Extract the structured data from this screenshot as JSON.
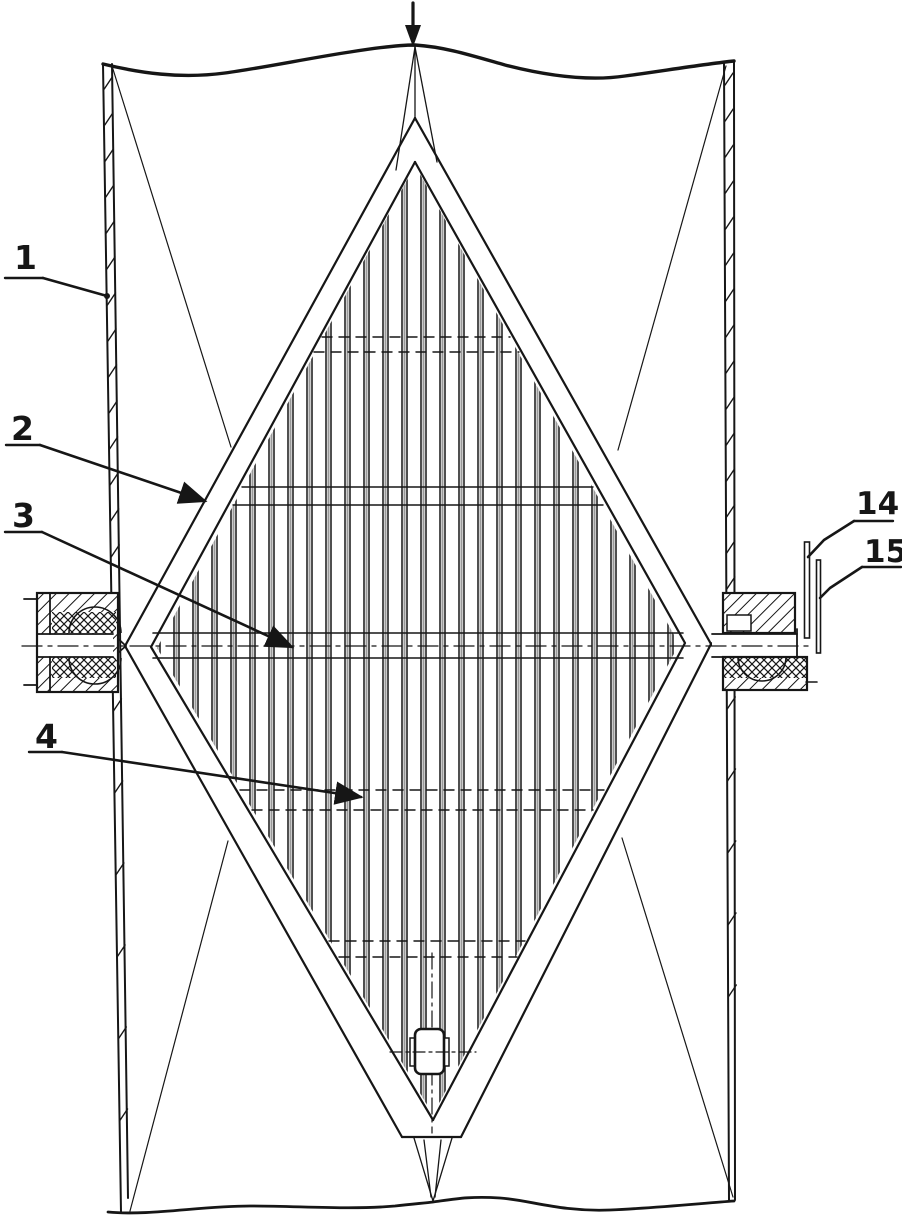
{
  "figure": {
    "kind": "patent-technical-drawing",
    "flow_arrow_symbol": "↓"
  },
  "colors": {
    "ink": "#161616",
    "paper": "#ffffff",
    "blade_shade": "#999999"
  },
  "labels": [
    {
      "text": "1",
      "tx": 14,
      "ty": 269,
      "size": 33,
      "underline": [
        5,
        278,
        43,
        278
      ],
      "leader": [
        [
          43,
          278
        ],
        [
          107,
          296
        ]
      ],
      "end": "dot"
    },
    {
      "text": "2",
      "tx": 11,
      "ty": 440,
      "size": 33,
      "underline": [
        6,
        445,
        40,
        445
      ],
      "leader": [
        [
          40,
          445
        ],
        [
          205,
          501
        ]
      ],
      "end": "arrow"
    },
    {
      "text": "3",
      "tx": 12,
      "ty": 527,
      "size": 33,
      "underline": [
        5,
        532,
        42,
        532
      ],
      "leader": [
        [
          42,
          532
        ],
        [
          292,
          647
        ]
      ],
      "end": "arrow"
    },
    {
      "text": "4",
      "tx": 35,
      "ty": 748,
      "size": 33,
      "underline": [
        29,
        752,
        62,
        752
      ],
      "leader": [
        [
          62,
          752
        ],
        [
          361,
          797
        ]
      ],
      "end": "arrow"
    },
    {
      "text": "14",
      "tx": 856,
      "ty": 514,
      "size": 31,
      "underline": [
        854,
        521,
        893,
        521
      ],
      "leader": [
        [
          854,
          521
        ],
        [
          824,
          540
        ],
        [
          808,
          557
        ]
      ],
      "end": "none"
    },
    {
      "text": "15",
      "tx": 864,
      "ty": 562,
      "size": 31,
      "underline": [
        862,
        567,
        901,
        567
      ],
      "leader": [
        [
          862,
          567
        ],
        [
          830,
          588
        ],
        [
          820,
          598
        ]
      ],
      "end": "none"
    }
  ],
  "geometry": {
    "canvas": {
      "w": 902,
      "h": 1220
    },
    "blades": {
      "x_start": 155,
      "step": 19,
      "count": 29,
      "gap": 5,
      "clip": "415,165 679,644 433,1115 157,648"
    },
    "tie_rods": [
      [
        337,
        322,
        510,
        1
      ],
      [
        352,
        314,
        519,
        1
      ],
      [
        487,
        242,
        593,
        0
      ],
      [
        505,
        233,
        603,
        0
      ],
      [
        790,
        240,
        604,
        1
      ],
      [
        810,
        252,
        593,
        1
      ],
      [
        941,
        329,
        525,
        1
      ],
      [
        957,
        339,
        517,
        1
      ]
    ],
    "axle": {
      "lines": [
        [
          153,
          633,
          683,
          633
        ],
        [
          153,
          658,
          683,
          658
        ]
      ],
      "center": [
        22,
        646,
        812,
        646
      ],
      "v_center": [
        432,
        953,
        432,
        1133
      ]
    },
    "frame": {
      "outer_left": [
        [
          415,
          118
        ],
        [
          125,
          646
        ],
        [
          402,
          1137
        ]
      ],
      "outer_right": [
        [
          415,
          118
        ],
        [
          711,
          644
        ],
        [
          461,
          1137
        ]
      ],
      "inner_left": [
        [
          415,
          162
        ],
        [
          151,
          647
        ],
        [
          433,
          1120
        ]
      ],
      "inner_right": [
        [
          415,
          162
        ],
        [
          685,
          643
        ],
        [
          433,
          1120
        ]
      ],
      "bottom_cut": [
        402,
        1137,
        461,
        1137
      ],
      "chamfers": [
        [
          113,
          634,
          126,
          646
        ],
        [
          113,
          657,
          126,
          646
        ],
        [
          723,
          634,
          711,
          644
        ],
        [
          723,
          657,
          711,
          644
        ]
      ]
    },
    "spikes": {
      "top": [
        [
          415,
          47,
          396,
          170
        ],
        [
          415,
          47,
          437,
          162
        ],
        [
          415,
          46,
          415,
          120
        ]
      ],
      "bottom": [
        [
          414,
          1138,
          433,
          1201
        ],
        [
          452,
          1138,
          433,
          1201
        ],
        [
          424,
          1140,
          431,
          1197
        ],
        [
          441,
          1140,
          435,
          1197
        ]
      ]
    },
    "funnel": [
      [
        112,
        66,
        231,
        447
      ],
      [
        726,
        66,
        618,
        450
      ],
      [
        130,
        1211,
        228,
        841
      ],
      [
        733,
        1197,
        622,
        838
      ]
    ],
    "walls": {
      "left": [
        [
          103,
          64,
          121,
          1212
        ],
        [
          112,
          64,
          128,
          1198
        ]
      ],
      "right": [
        [
          734,
          62,
          735,
          1200
        ],
        [
          724,
          62,
          729,
          1200
        ]
      ],
      "hatch_left": {
        "y1": 80,
        "y2": 578,
        "step": 36,
        "y3": 702,
        "y4": 1150,
        "step2": 82
      },
      "hatch_right": {
        "y1": 76,
        "y2": 582,
        "step": 36,
        "y3": 700,
        "y4": 1005,
        "step2": 72
      }
    },
    "wavy": {
      "top": "M 103 64 C 140 73 180 79 225 73 C 262 68 310 58 350 52 C 375 48 400 45 415 45 C 445 47 470 55 505 65 C 540 74 585 82 625 76 C 662 71 705 64 734 61",
      "bottom": "M 108 1212 C 150 1216 200 1206 250 1206 C 300 1206 350 1210 395 1206 C 412 1204 425 1203 433 1202 C 455 1199 470 1196 500 1198 C 530 1200 560 1212 610 1210 C 655 1208 705 1203 734 1201"
    },
    "flow_arrow": {
      "line": [
        413,
        3,
        413,
        27
      ],
      "head": "405,25 421,25 413,47"
    },
    "left_bearing": {
      "body": [
        37,
        593,
        81,
        99
      ],
      "flange_x": 50,
      "xx": [
        [
          52,
          612,
          64,
          21
        ],
        [
          52,
          656,
          64,
          22
        ]
      ],
      "arcs": [
        "M 69 633 A 26 26 0 0 1 121 633",
        "M 69 658 A 26 26 0 0 0 121 658"
      ],
      "channel": [
        38,
        634,
        75,
        23
      ],
      "stubs": [
        [
          24,
          599,
          37,
          599
        ],
        [
          24,
          685,
          37,
          685
        ]
      ]
    },
    "right_bearing": {
      "top_band": [
        723,
        593,
        72,
        40
      ],
      "notch": [
        727,
        615,
        24,
        16
      ],
      "channel": [
        712,
        634,
        95,
        23
      ],
      "channel_tick": [
        797,
        629,
        797,
        658
      ],
      "xx_band": [
        723,
        657,
        84,
        21
      ],
      "dh_band": [
        723,
        678,
        84,
        12
      ],
      "outline_bottom": [
        723,
        657,
        84,
        33
      ],
      "tick": [
        806,
        682,
        817,
        682
      ],
      "arc": "M 738 657 A 24 24 0 0 0 786 657"
    },
    "plates": [
      {
        "x": 804.5,
        "w": 5,
        "y1": 542,
        "y2": 638
      },
      {
        "x": 816.5,
        "w": 4,
        "y1": 560,
        "y2": 653
      }
    ],
    "block": {
      "rect": [
        415,
        1029,
        29,
        45,
        6
      ],
      "tabs": [
        [
          410,
          1038,
          5,
          28
        ],
        [
          444,
          1038,
          5,
          28
        ]
      ],
      "dashdot": [
        390,
        1052,
        476,
        1052
      ]
    }
  }
}
